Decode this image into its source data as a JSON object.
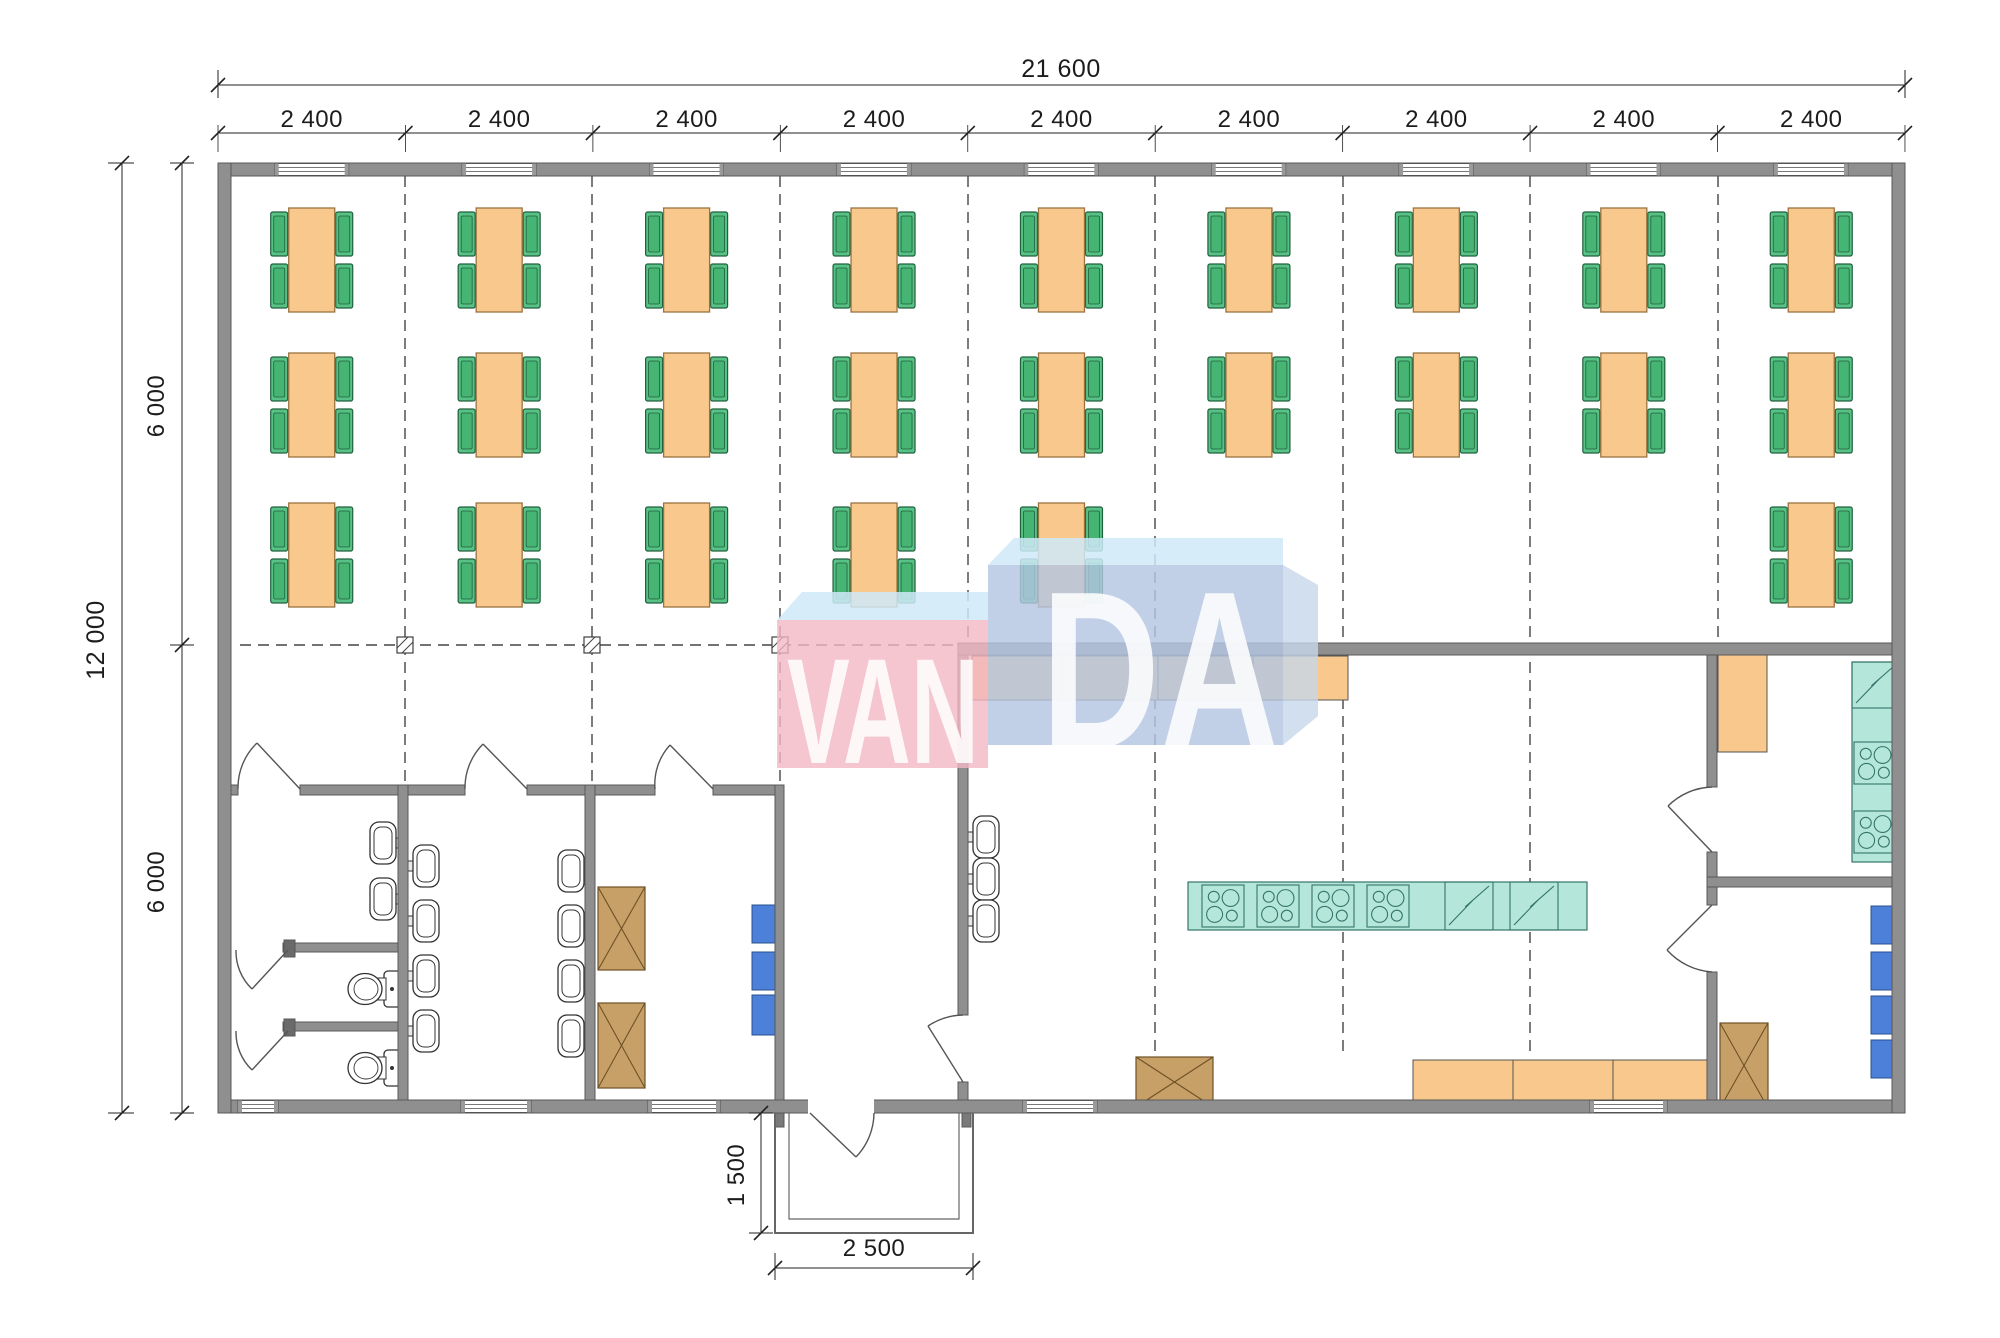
{
  "plan": {
    "watermark": {
      "left": "VAN",
      "right": "DA"
    },
    "labels": {
      "total_width": "21 600",
      "bay_width": "2 400",
      "total_height": "12 000",
      "half_height": "6 000",
      "porch_depth": "1 500",
      "porch_width": "2 500"
    },
    "grid": {
      "origin_x": 218,
      "bay_pitch": 187.44,
      "bay_count": 9,
      "dim_line_y": 133,
      "dashed_v": [
        {
          "x": 405,
          "y1": 176,
          "y2": 785
        },
        {
          "x": 592,
          "y1": 176,
          "y2": 785
        },
        {
          "x": 780,
          "y1": 176,
          "y2": 785
        },
        {
          "x": 968,
          "y1": 176,
          "y2": 643
        },
        {
          "x": 1155,
          "y1": 176,
          "y2": 1056
        },
        {
          "x": 1343,
          "y1": 176,
          "y2": 1056
        },
        {
          "x": 1530,
          "y1": 176,
          "y2": 1058
        },
        {
          "x": 1718,
          "y1": 176,
          "y2": 642
        }
      ],
      "dashed_h": [
        {
          "y": 645,
          "x1": 240,
          "x2": 955
        }
      ],
      "columns": [
        {
          "x": 405,
          "y": 645
        },
        {
          "x": 592,
          "y": 645
        },
        {
          "x": 780,
          "y": 645
        }
      ]
    },
    "windows": {
      "top_centers": [
        311.7,
        499.1,
        686.5,
        873.9,
        1061.3,
        1248.7,
        1436.1,
        1623.5,
        1810.9
      ],
      "top_width": 74,
      "bottom_spans": [
        [
          238,
          278
        ],
        [
          461,
          531
        ],
        [
          648,
          720
        ],
        [
          1023,
          1097
        ],
        [
          1590,
          1667
        ]
      ]
    },
    "dining": {
      "rows": [
        {
          "cy": 260,
          "bays": [
            0,
            1,
            2,
            3,
            4,
            5,
            6,
            7,
            8
          ]
        },
        {
          "cy": 405,
          "bays": [
            0,
            1,
            2,
            3,
            4,
            5,
            6,
            7,
            8
          ]
        },
        {
          "cy": 555,
          "bays": [
            0,
            1,
            2,
            3,
            4,
            8
          ]
        }
      ]
    },
    "fixtures": {
      "counters": [
        {
          "x": 972,
          "y": 656,
          "w": 376,
          "h": 44,
          "div": [
            1063,
            1158,
            1253
          ]
        },
        {
          "x": 1413,
          "y": 1060,
          "w": 300,
          "h": 48,
          "div": [
            1513,
            1613
          ]
        },
        {
          "x": 1718,
          "y": 652,
          "w": 49,
          "h": 100,
          "div": []
        }
      ],
      "island": {
        "x": 1188,
        "y": 882,
        "w": 399,
        "h": 48
      },
      "island_stoves": [
        {
          "x": 1202,
          "y": 885,
          "s": 42
        },
        {
          "x": 1257,
          "y": 885,
          "s": 42
        },
        {
          "x": 1312,
          "y": 885,
          "s": 42
        },
        {
          "x": 1367,
          "y": 885,
          "s": 42
        }
      ],
      "island_z": [
        {
          "x": 1445,
          "y": 882,
          "s": 48
        },
        {
          "x": 1510,
          "y": 882,
          "s": 48
        }
      ],
      "wall_strip": {
        "x": 1852,
        "y": 662,
        "w": 46,
        "h": 200,
        "div_y": [
          708
        ]
      },
      "strip_stoves": [
        {
          "x": 1854,
          "y": 742,
          "s": 42
        },
        {
          "x": 1854,
          "y": 811,
          "s": 42
        }
      ],
      "strip_z": [
        {
          "x": 1852,
          "y": 662,
          "s": 46
        }
      ],
      "sinks": [
        {
          "x": 370,
          "y": 822,
          "dir": "left"
        },
        {
          "x": 370,
          "y": 878,
          "dir": "left"
        },
        {
          "x": 408,
          "y": 845,
          "dir": "right"
        },
        {
          "x": 408,
          "y": 900,
          "dir": "right"
        },
        {
          "x": 408,
          "y": 955,
          "dir": "right"
        },
        {
          "x": 408,
          "y": 1010,
          "dir": "right"
        },
        {
          "x": 558,
          "y": 850,
          "dir": "left"
        },
        {
          "x": 558,
          "y": 905,
          "dir": "left"
        },
        {
          "x": 558,
          "y": 960,
          "dir": "left"
        },
        {
          "x": 558,
          "y": 1015,
          "dir": "left"
        },
        {
          "x": 968,
          "y": 816,
          "dir": "right"
        },
        {
          "x": 968,
          "y": 858,
          "dir": "right"
        },
        {
          "x": 968,
          "y": 900,
          "dir": "right"
        }
      ],
      "toilets": [
        {
          "x": 348,
          "y": 970
        },
        {
          "x": 348,
          "y": 1049
        }
      ],
      "lockers": [
        {
          "x": 752,
          "y": 905,
          "w": 23,
          "h": 38
        },
        {
          "x": 752,
          "y": 952,
          "w": 23,
          "h": 38
        },
        {
          "x": 752,
          "y": 995,
          "w": 23,
          "h": 40
        },
        {
          "x": 1871,
          "y": 906,
          "w": 21,
          "h": 38
        },
        {
          "x": 1871,
          "y": 952,
          "w": 21,
          "h": 38
        },
        {
          "x": 1871,
          "y": 996,
          "w": 21,
          "h": 38
        },
        {
          "x": 1871,
          "y": 1040,
          "w": 21,
          "h": 38
        }
      ],
      "xboxes": [
        {
          "x": 598,
          "y": 887,
          "w": 47,
          "h": 83
        },
        {
          "x": 598,
          "y": 1003,
          "w": 47,
          "h": 85
        },
        {
          "x": 1720,
          "y": 1023,
          "w": 48,
          "h": 85
        },
        {
          "x": 1136,
          "y": 1057,
          "w": 77,
          "h": 50
        }
      ]
    },
    "colors": {
      "wall": "#8f8f8f",
      "wall_stroke": "#585858",
      "table": "#f8c88d",
      "table_stroke": "#9a7340",
      "chair": "#58c186",
      "chair_inner": "#46b473",
      "chair_stroke": "#20603d",
      "teal": "#b4e7da",
      "teal_stroke": "#35756a",
      "locker_blue": "#4d80d8",
      "locker_stroke": "#27508f",
      "cabinet_brown": "#c7a067",
      "cabinet_stroke": "#6e5126",
      "counter": "#f8c88d",
      "counter_stroke": "#555555",
      "fixture_stroke": "#333333",
      "grid": "#454545",
      "dim": "#222222",
      "door": "#555555",
      "watermark_pink": "#f2b6c4",
      "watermark_blue": "#b3c6e2",
      "watermark_light": "#cfe9f8",
      "watermark_side": "#c5d7ea"
    }
  }
}
